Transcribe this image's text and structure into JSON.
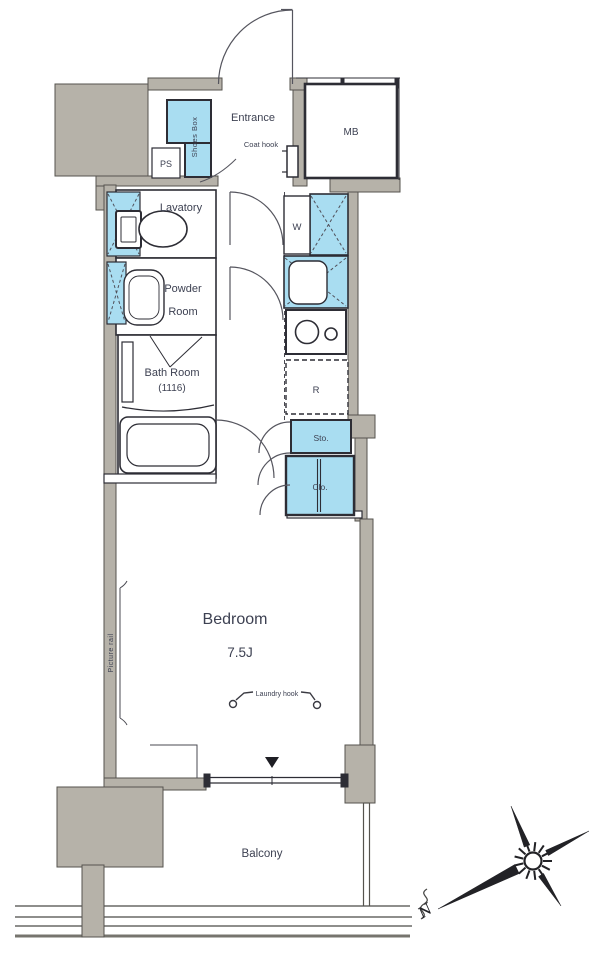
{
  "floorplan": {
    "entrance": {
      "label": "Entrance",
      "coat_hook": "Coat hook",
      "shoes_box": "Shoes Box",
      "ps": "PS",
      "mb": "MB"
    },
    "sanitary": {
      "lavatory": "Lavatory",
      "powder_line1": "Powder",
      "powder_line2": "Room",
      "bath_line1": "Bath Room",
      "bath_line2": "(1116)"
    },
    "kitchen": {
      "washer": "W",
      "fridge": "R",
      "storage": "Sto.",
      "closet": "Clo."
    },
    "bedroom": {
      "label": "Bedroom",
      "size": "7.5J",
      "laundry_hook": "Laundry hook",
      "picture_rail": "Picture rail"
    },
    "outdoor": {
      "balcony": "Balcony",
      "compass_north": "N"
    },
    "colors": {
      "fixture_cyan": "#a9ddf1",
      "wall_gray": "#b6b2a9",
      "line": "#2d2d35",
      "label": "#3d4152"
    }
  }
}
